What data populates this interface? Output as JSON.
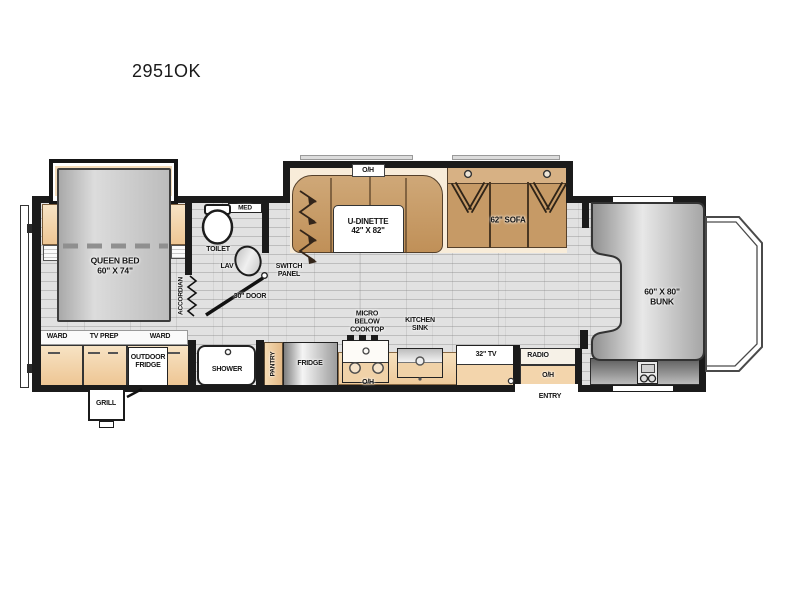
{
  "title": "2951OK",
  "colors": {
    "wall": "#1b1b1b",
    "cabinet_peach": "#f2d3a7",
    "wood_brown": "#c4945e",
    "floor_gray": "#e1e1e1",
    "bed_gray": "#c6c6c6",
    "slide_cream": "#f8ecd9"
  },
  "rooms": {
    "bedroom": {
      "bed_l1": "QUEEN BED",
      "bed_l2": "60\" X 74\"",
      "ward_left": "WARD",
      "tv_prep": "TV PREP",
      "ward_right": "WARD",
      "outdoor_l1": "OUTDOOR",
      "outdoor_l2": "FRIDGE",
      "grill": "GRILL",
      "accordian": "ACCORDIAN"
    },
    "bathroom": {
      "med": "MED",
      "toilet": "TOILET",
      "lav": "LAV",
      "switch_l1": "SWITCH",
      "switch_l2": "PANEL",
      "door30": "30\" DOOR",
      "shower": "SHOWER"
    },
    "kitchen": {
      "pantry": "PANTRY",
      "fridge": "FRIDGE",
      "micro_l1": "MICRO",
      "micro_l2": "BELOW",
      "micro_l3": "COOKTOP",
      "sink_l1": "KITCHEN",
      "sink_l2": "SINK",
      "oh_cooktop": "O/H"
    },
    "living": {
      "oh_dinette": "O/H",
      "dinette_l1": "U-DINETTE",
      "dinette_l2": "42\" X 82\"",
      "sofa": "62\" SOFA",
      "tv": "32\" TV",
      "radio": "RADIO",
      "oh_entry": "O/H",
      "entry": "ENTRY"
    },
    "cab": {
      "bunk_l1": "60\" X 80\"",
      "bunk_l2": "BUNK"
    }
  }
}
